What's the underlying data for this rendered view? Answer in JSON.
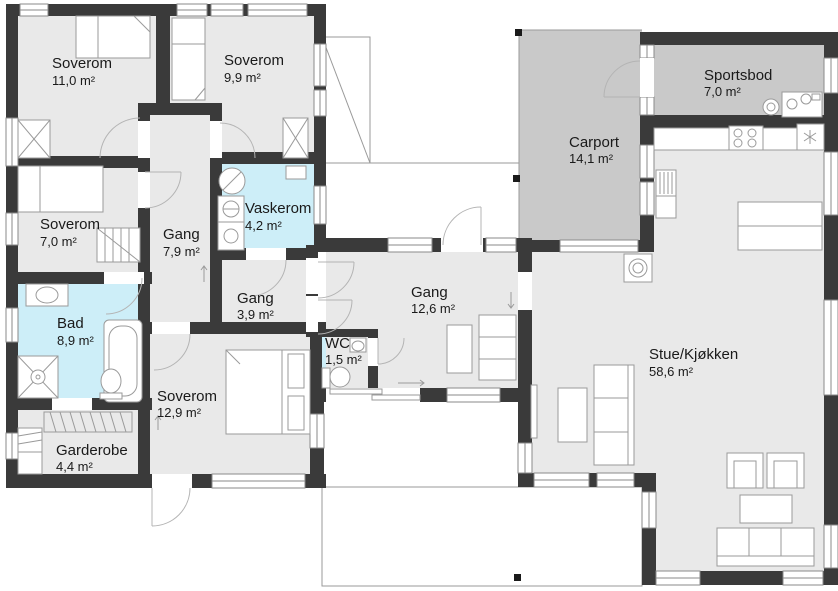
{
  "plan": {
    "rooms": [
      {
        "name": "Soverom",
        "area": "11,0 m²"
      },
      {
        "name": "Soverom",
        "area": "9,9 m²"
      },
      {
        "name": "Soverom",
        "area": "7,0 m²"
      },
      {
        "name": "Gang",
        "area": "7,9 m²"
      },
      {
        "name": "Vaskerom",
        "area": "4,2 m²"
      },
      {
        "name": "Gang",
        "area": "3,9 m²"
      },
      {
        "name": "Bad",
        "area": "8,9 m²"
      },
      {
        "name": "WC",
        "area": "1,5 m²"
      },
      {
        "name": "Gang",
        "area": "12,6 m²"
      },
      {
        "name": "Soverom",
        "area": "12,9 m²"
      },
      {
        "name": "Garderobe",
        "area": "4,4 m²"
      },
      {
        "name": "Carport",
        "area": "14,1 m²"
      },
      {
        "name": "Sportsbod",
        "area": "7,0 m²"
      },
      {
        "name": "Stue/Kjøkken",
        "area": "58,6 m²"
      }
    ],
    "colors": {
      "wall": "#3a3a3a",
      "floor": "#e9e9e9",
      "wet_floor": "#cdeef8",
      "outdoor_floor": "#c9c9c9",
      "outline": "#9a9a9a",
      "text": "#1a1a1a",
      "background": "#ffffff"
    }
  }
}
